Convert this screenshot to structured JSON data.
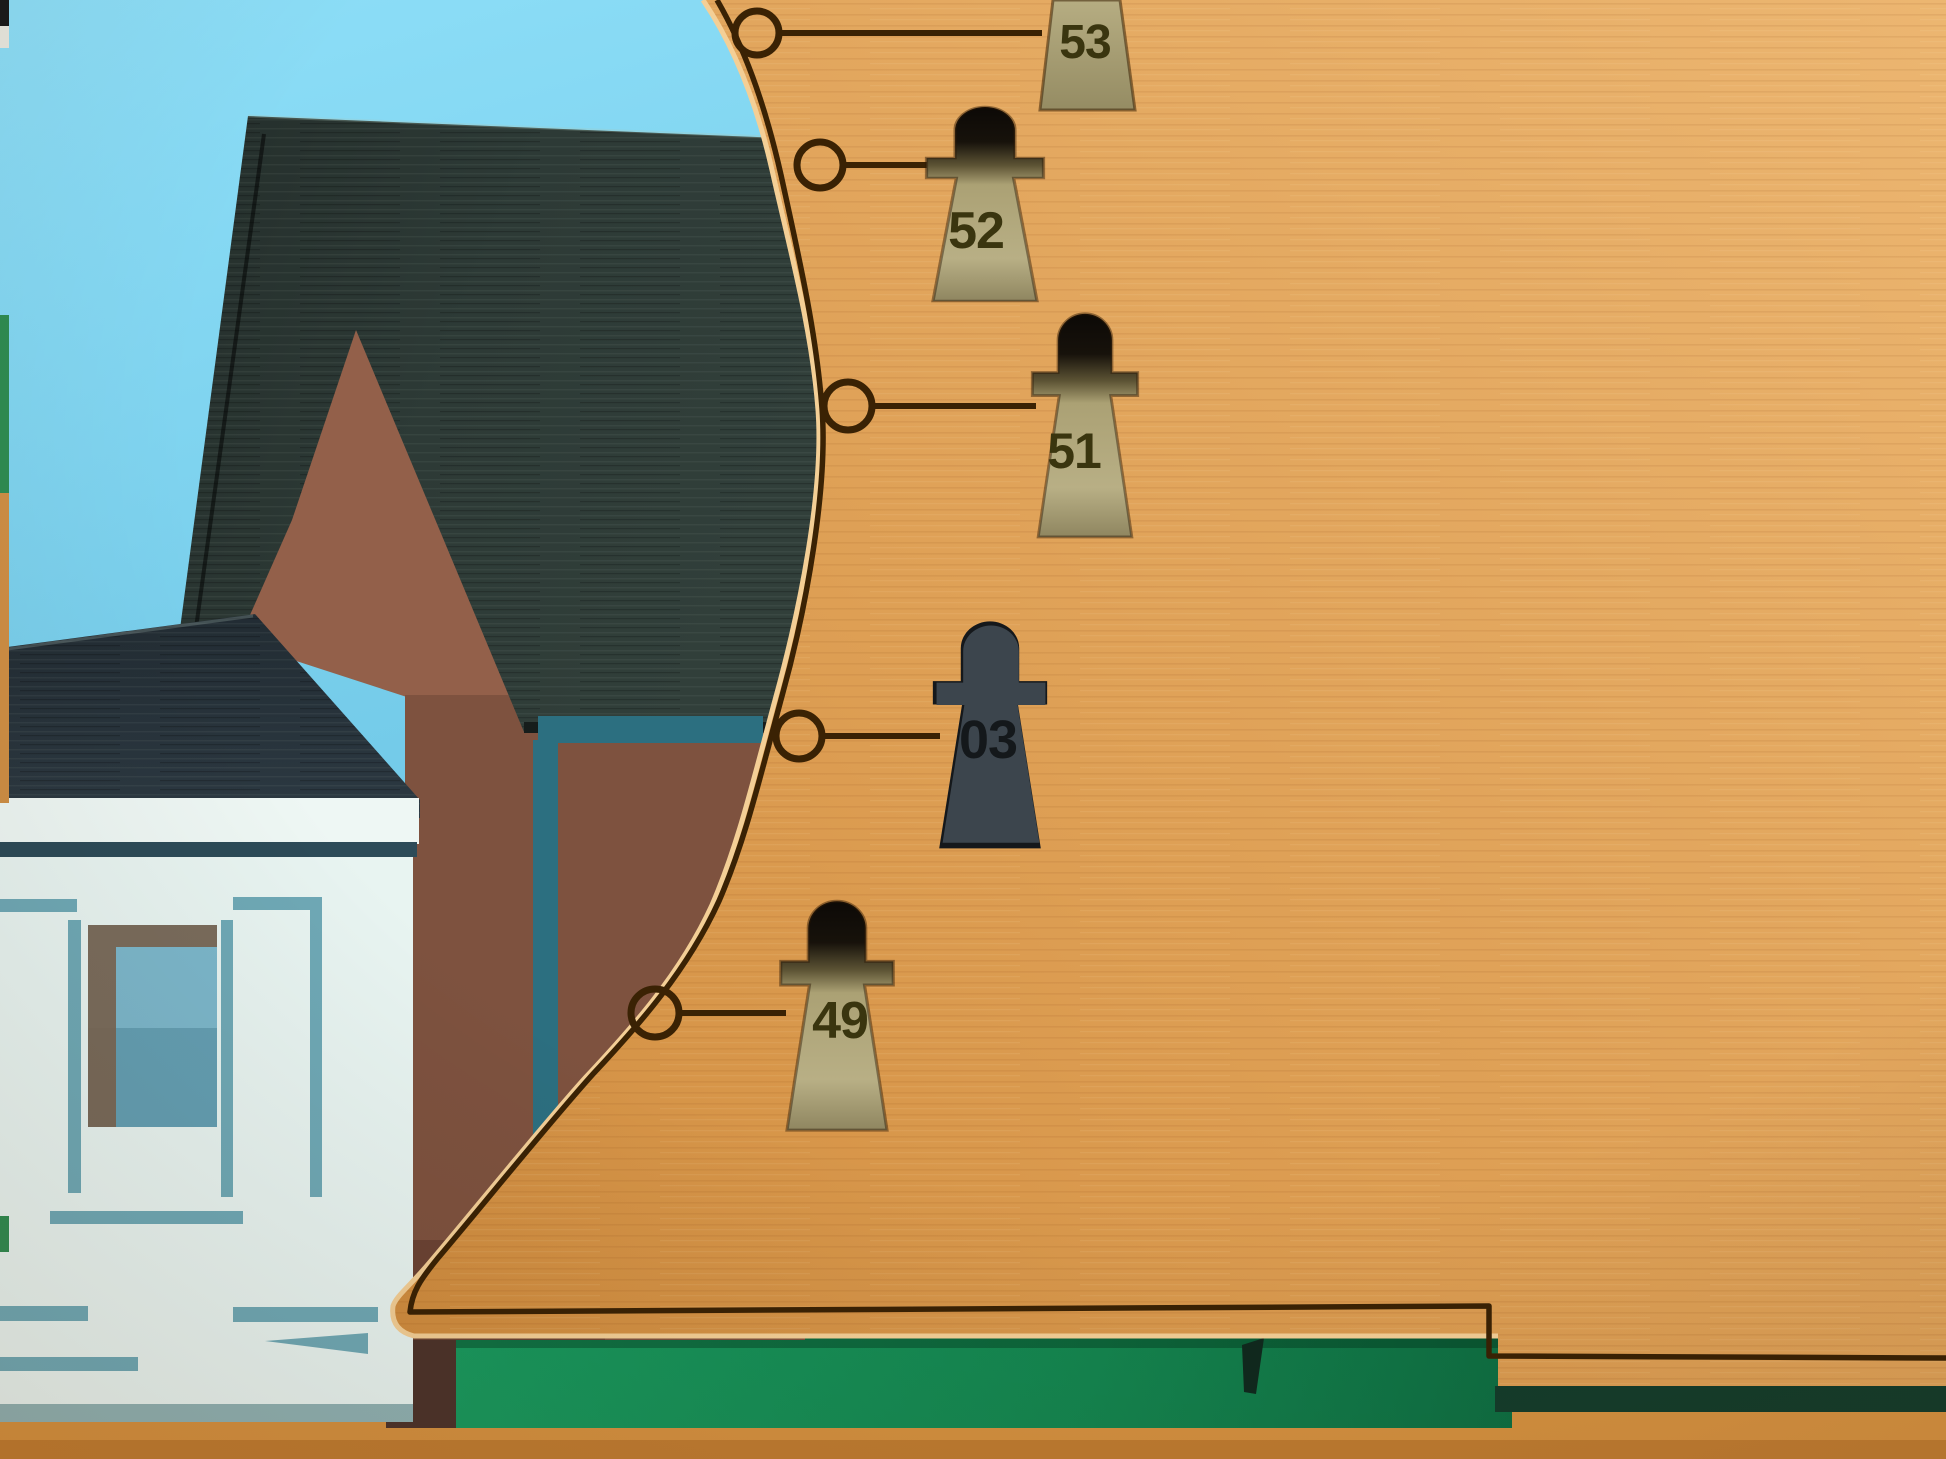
{
  "markers": {
    "items": [
      {
        "label": "53",
        "type": "cutout"
      },
      {
        "label": "52",
        "type": "cutout"
      },
      {
        "label": "51",
        "type": "cutout"
      },
      {
        "label": "03",
        "type": "dark-piece"
      },
      {
        "label": "49",
        "type": "cutout"
      }
    ]
  },
  "colors": {
    "sky": "#84d7f2",
    "board": "#dd9c51",
    "board_light": "#ecb671",
    "board_edge_highlight": "#f4cf96",
    "engrave": "#3a2204",
    "main_roof": "#2d3a36",
    "house_roof": "#28333a",
    "gable_brown": "#93604a",
    "wall_brown": "#7e523f",
    "under_board_brown": "#4c332b",
    "teal_shadow": "#2c6f80",
    "house_white": "#e8f4f1",
    "groove_teal": "#6fa9b6",
    "groove_dark": "#2d4b58",
    "window_blue": "#7cb7cb",
    "window_shadow": "#7a6450",
    "khaki_layer": "#b2a97c",
    "number_engrave": "#3a350f",
    "piece_dark": "#3c454d",
    "piece_engrave": "#14181b",
    "green_strip": "#169158",
    "green_dark": "#143c2b",
    "base_wood": "#d59140",
    "house_bottom_shadow": "#8fb2b4",
    "sliver_green": "#2f8c52"
  }
}
